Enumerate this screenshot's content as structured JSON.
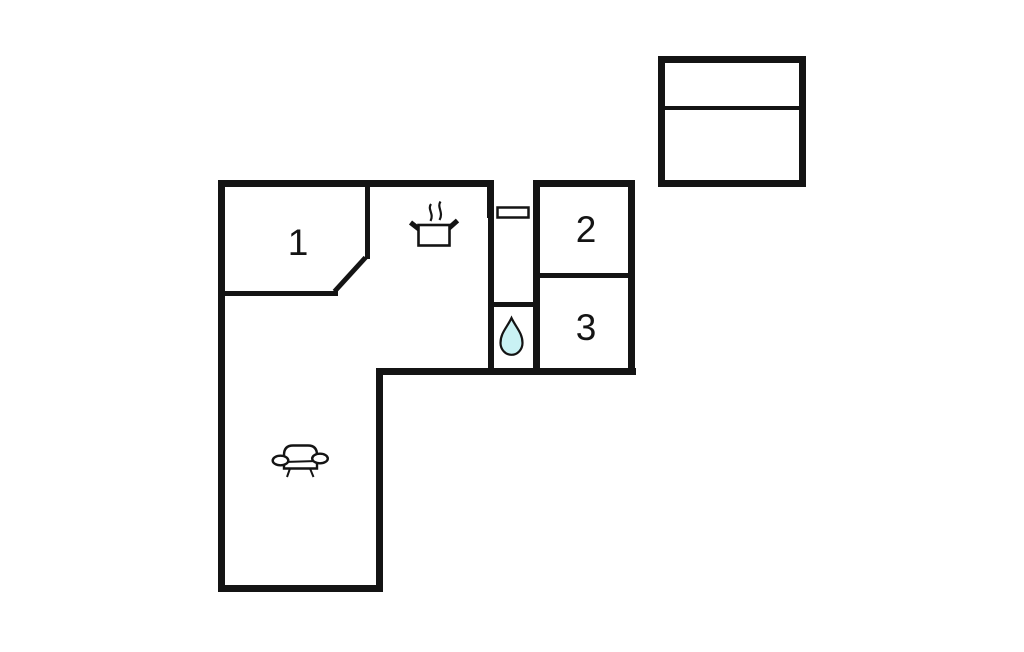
{
  "page": {
    "background_color": "#ffffff",
    "wall_color": "#141414"
  },
  "floorplan": {
    "kind": "floor-plan",
    "rooms": [
      {
        "id": "room-1",
        "label": "1"
      },
      {
        "id": "room-2",
        "label": "2"
      },
      {
        "id": "room-3",
        "label": "3"
      }
    ],
    "icons": [
      {
        "name": "stove-pot-icon",
        "meaning": "kitchen"
      },
      {
        "name": "water-drop-icon",
        "meaning": "bathroom",
        "fill": "#c9f2f4"
      },
      {
        "name": "sofa-icon",
        "meaning": "living-room"
      }
    ],
    "entrance": {
      "symbol": "door",
      "location": "top-of-hallway"
    },
    "annex": {
      "sections": 2
    }
  }
}
